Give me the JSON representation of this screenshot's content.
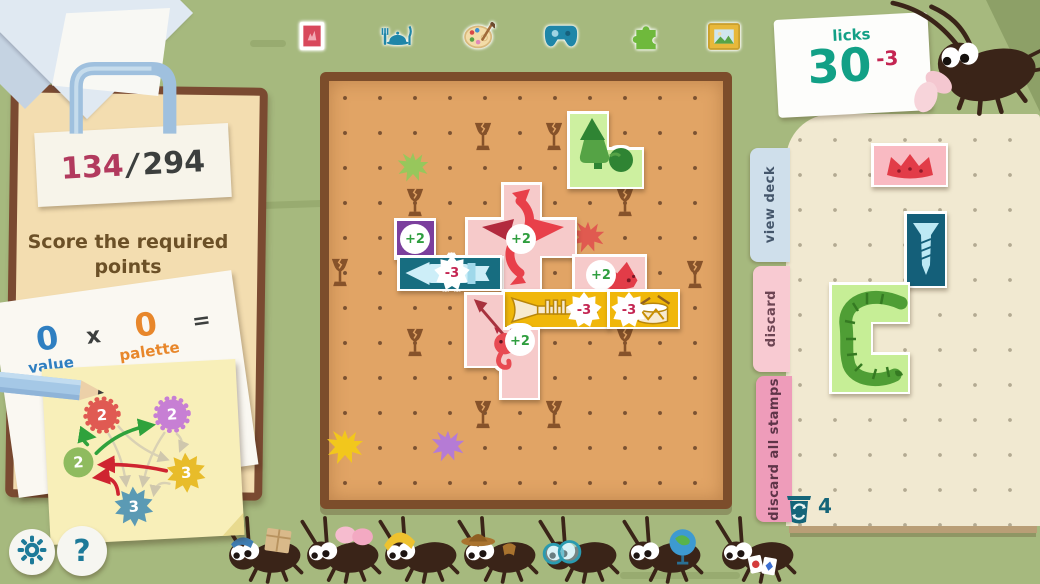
{
  "colors": {
    "background": "#a6b97e",
    "board": "#e1a465",
    "board_border": "#7c4d2b",
    "clipboard": "#f3ddb0",
    "teal": "#12a086",
    "crimson": "#c42552",
    "score_red": "#b23a5e",
    "text_dark": "#3c3f3e",
    "text_brown": "#6b5027",
    "value_blue": "#2f7fc1",
    "palette_orange": "#e8872b",
    "plus_green": "#2f9e3f",
    "page_cream": "#f1e9d1"
  },
  "header": {
    "previous_stamp_count": "18",
    "previous_stamp_label": "Previous Stamp",
    "categories": [
      {
        "name": "stamp-category"
      },
      {
        "name": "dinner-category"
      },
      {
        "name": "art-palette-category"
      },
      {
        "name": "game-controller-category"
      },
      {
        "name": "puzzle-category"
      },
      {
        "name": "picture-frame-category"
      }
    ]
  },
  "licks": {
    "label": "licks",
    "count": "30",
    "delta": "-3"
  },
  "clipboard": {
    "score_current": "134",
    "score_divider": "/",
    "score_target": "294",
    "instruction": "Score the required points"
  },
  "formula": {
    "value_number": "0",
    "value_label": "value",
    "times": "x",
    "palette_number": "0",
    "palette_label": "palette",
    "equals": "="
  },
  "note": {
    "nodes": [
      {
        "id": "red",
        "shape": "flower",
        "color": "#e05a52",
        "value": "2",
        "x": 58,
        "y": 49
      },
      {
        "id": "purple",
        "shape": "flower",
        "color": "#c77fd4",
        "value": "2",
        "x": 128,
        "y": 52
      },
      {
        "id": "green",
        "shape": "circle",
        "color": "#8fbb5f",
        "value": "2",
        "x": 32,
        "y": 95
      },
      {
        "id": "yellow",
        "shape": "burst",
        "color": "#e8bc2a",
        "value": "3",
        "x": 139,
        "y": 111
      },
      {
        "id": "blue",
        "shape": "burst",
        "color": "#5b9ab4",
        "value": "3",
        "x": 85,
        "y": 142
      }
    ],
    "strong_arrows": [
      {
        "from": "green",
        "to": "red",
        "color": "#2fa23c",
        "bend": -14
      },
      {
        "from": "green",
        "to": "purple",
        "color": "#2fa23c",
        "bend": -10
      },
      {
        "from": "yellow",
        "to": "green",
        "color": "#cf2430",
        "bend": 4
      },
      {
        "from": "blue",
        "to": "green",
        "color": "#cf2430",
        "bend": 14
      }
    ],
    "faint_arrows": [
      {
        "from": "red",
        "to": "yellow",
        "bend": 8
      },
      {
        "from": "red",
        "to": "blue",
        "bend": -6
      },
      {
        "from": "purple",
        "to": "blue",
        "bend": 6
      },
      {
        "from": "purple",
        "to": "yellow",
        "bend": -6
      },
      {
        "from": "yellow",
        "to": "blue",
        "bend": 10
      }
    ]
  },
  "board": {
    "x": 320,
    "y": 72,
    "w": 412,
    "h": 437,
    "hazard_icon": "broken-glass",
    "hazards": [
      [
        483,
        137
      ],
      [
        554,
        137
      ],
      [
        415,
        203
      ],
      [
        625,
        203
      ],
      [
        340,
        273
      ],
      [
        695,
        275
      ],
      [
        415,
        343
      ],
      [
        625,
        343
      ],
      [
        483,
        415
      ],
      [
        554,
        415
      ]
    ],
    "splats": [
      {
        "x": 413,
        "y": 168,
        "color": "#97c75c",
        "size": 34
      },
      {
        "x": 588,
        "y": 238,
        "color": "#e05a50",
        "size": 36
      },
      {
        "x": 345,
        "y": 448,
        "color": "#f2c71c",
        "size": 40
      },
      {
        "x": 448,
        "y": 447,
        "color": "#b57bd5",
        "size": 36
      }
    ],
    "stamps": [
      {
        "name": "gnome-stamp",
        "color": "#cdf0a0",
        "icon": "gnome",
        "icon_box": [
          572,
          116,
          66,
          66
        ],
        "cells": [
          [
            570,
            114,
            37,
            37
          ],
          [
            570,
            150,
            37,
            37
          ],
          [
            606,
            150,
            36,
            37
          ]
        ]
      },
      {
        "name": "plus-two-purple-stamp",
        "color": "#7b3f9d",
        "cells": [
          [
            397,
            221,
            37,
            37
          ]
        ],
        "badge": {
          "text": "+2",
          "type": "plus",
          "x": 415,
          "y": 239
        }
      },
      {
        "name": "dragon-stamp",
        "color": "#f6caca",
        "icon": "dragon",
        "icon_box": [
          468,
          187,
          107,
          104
        ],
        "cells": [
          [
            504,
            185,
            36,
            36
          ],
          [
            468,
            220,
            37,
            36
          ],
          [
            504,
            220,
            36,
            36
          ],
          [
            539,
            220,
            36,
            36
          ],
          [
            504,
            255,
            36,
            36
          ]
        ],
        "badge": {
          "text": "+2",
          "type": "plus",
          "x": 521,
          "y": 239
        }
      },
      {
        "name": "rocket-stamp",
        "color": "#176d80",
        "icon": "rocket",
        "icon_box": [
          403,
          260,
          93,
          27
        ],
        "cells": [
          [
            400,
            258,
            100,
            31
          ]
        ],
        "badge": {
          "text": "-3",
          "type": "minus",
          "x": 452,
          "y": 273
        }
      },
      {
        "name": "fox-stamp",
        "color": "#f6caca",
        "icon": "fox",
        "icon_box": [
          598,
          259,
          46,
          31
        ],
        "cells": [
          [
            575,
            257,
            70,
            35
          ]
        ],
        "badge": {
          "text": "+2",
          "type": "plus",
          "x": 601,
          "y": 275
        }
      },
      {
        "name": "trumpet-stamp",
        "color": "#f0b70a",
        "icon": "trumpet",
        "icon_box": [
          508,
          295,
          93,
          30
        ],
        "cells": [
          [
            505,
            292,
            103,
            35
          ]
        ],
        "badge": {
          "text": "-3",
          "type": "minus",
          "x": 584,
          "y": 310
        }
      },
      {
        "name": "drum-stamp",
        "color": "#f0b70a",
        "icon": "drum",
        "icon_box": [
          630,
          294,
          46,
          33
        ],
        "cells": [
          [
            610,
            292,
            68,
            35
          ]
        ],
        "badge": {
          "text": "-3",
          "type": "minus",
          "x": 629,
          "y": 310
        }
      },
      {
        "name": "imp-stamp",
        "color": "#f6caca",
        "icon": "imp",
        "icon_box": [
          468,
          297,
          64,
          74
        ],
        "cells": [
          [
            467,
            295,
            36,
            36
          ],
          [
            467,
            330,
            36,
            36
          ],
          [
            502,
            330,
            36,
            36
          ],
          [
            502,
            365,
            36,
            33
          ]
        ],
        "badge": {
          "text": "+2",
          "type": "plus",
          "x": 520,
          "y": 341
        }
      }
    ]
  },
  "deck_panel": {
    "tabs": [
      {
        "label": "view deck",
        "color": "#cfdfeb",
        "text_color": "#44566b"
      },
      {
        "label": "discard",
        "color": "#f8cad2",
        "text_color": "#6d4553"
      },
      {
        "label": "discard all stamps",
        "color": "#ee9cba",
        "text_color": "#5e3448"
      }
    ],
    "bin_count": "4",
    "stamps": [
      {
        "name": "crown-stamp",
        "color": "#f9bac2",
        "icon": "crown",
        "icon_box": [
          884,
          151,
          52,
          30
        ],
        "cells": [
          [
            874,
            146,
            72,
            39
          ]
        ]
      },
      {
        "name": "screw-stamp",
        "color": "#145f79",
        "icon": "screw",
        "icon_box": [
          911,
          221,
          30,
          58
        ],
        "cells": [
          [
            907,
            214,
            38,
            72
          ]
        ]
      },
      {
        "name": "worm-stamp",
        "color": "#c6ee96",
        "icon": "worm",
        "icon_box": [
          833,
          287,
          76,
          104
        ],
        "cells": [
          [
            832,
            285,
            39,
            37
          ],
          [
            870,
            285,
            38,
            37
          ],
          [
            832,
            321,
            39,
            35
          ],
          [
            832,
            355,
            39,
            37
          ],
          [
            870,
            355,
            38,
            37
          ]
        ]
      }
    ]
  },
  "bugs": [
    {
      "accessory": "package-box",
      "x": 262
    },
    {
      "accessory": "pink-bow",
      "x": 340
    },
    {
      "accessory": "yellow-beanie",
      "x": 418
    },
    {
      "accessory": "cowboy-hat",
      "x": 497
    },
    {
      "accessory": "round-glasses",
      "x": 578
    },
    {
      "accessory": "globe",
      "x": 662
    },
    {
      "accessory": "playing-cards",
      "x": 755
    }
  ],
  "footer": {
    "help_label": "?"
  }
}
